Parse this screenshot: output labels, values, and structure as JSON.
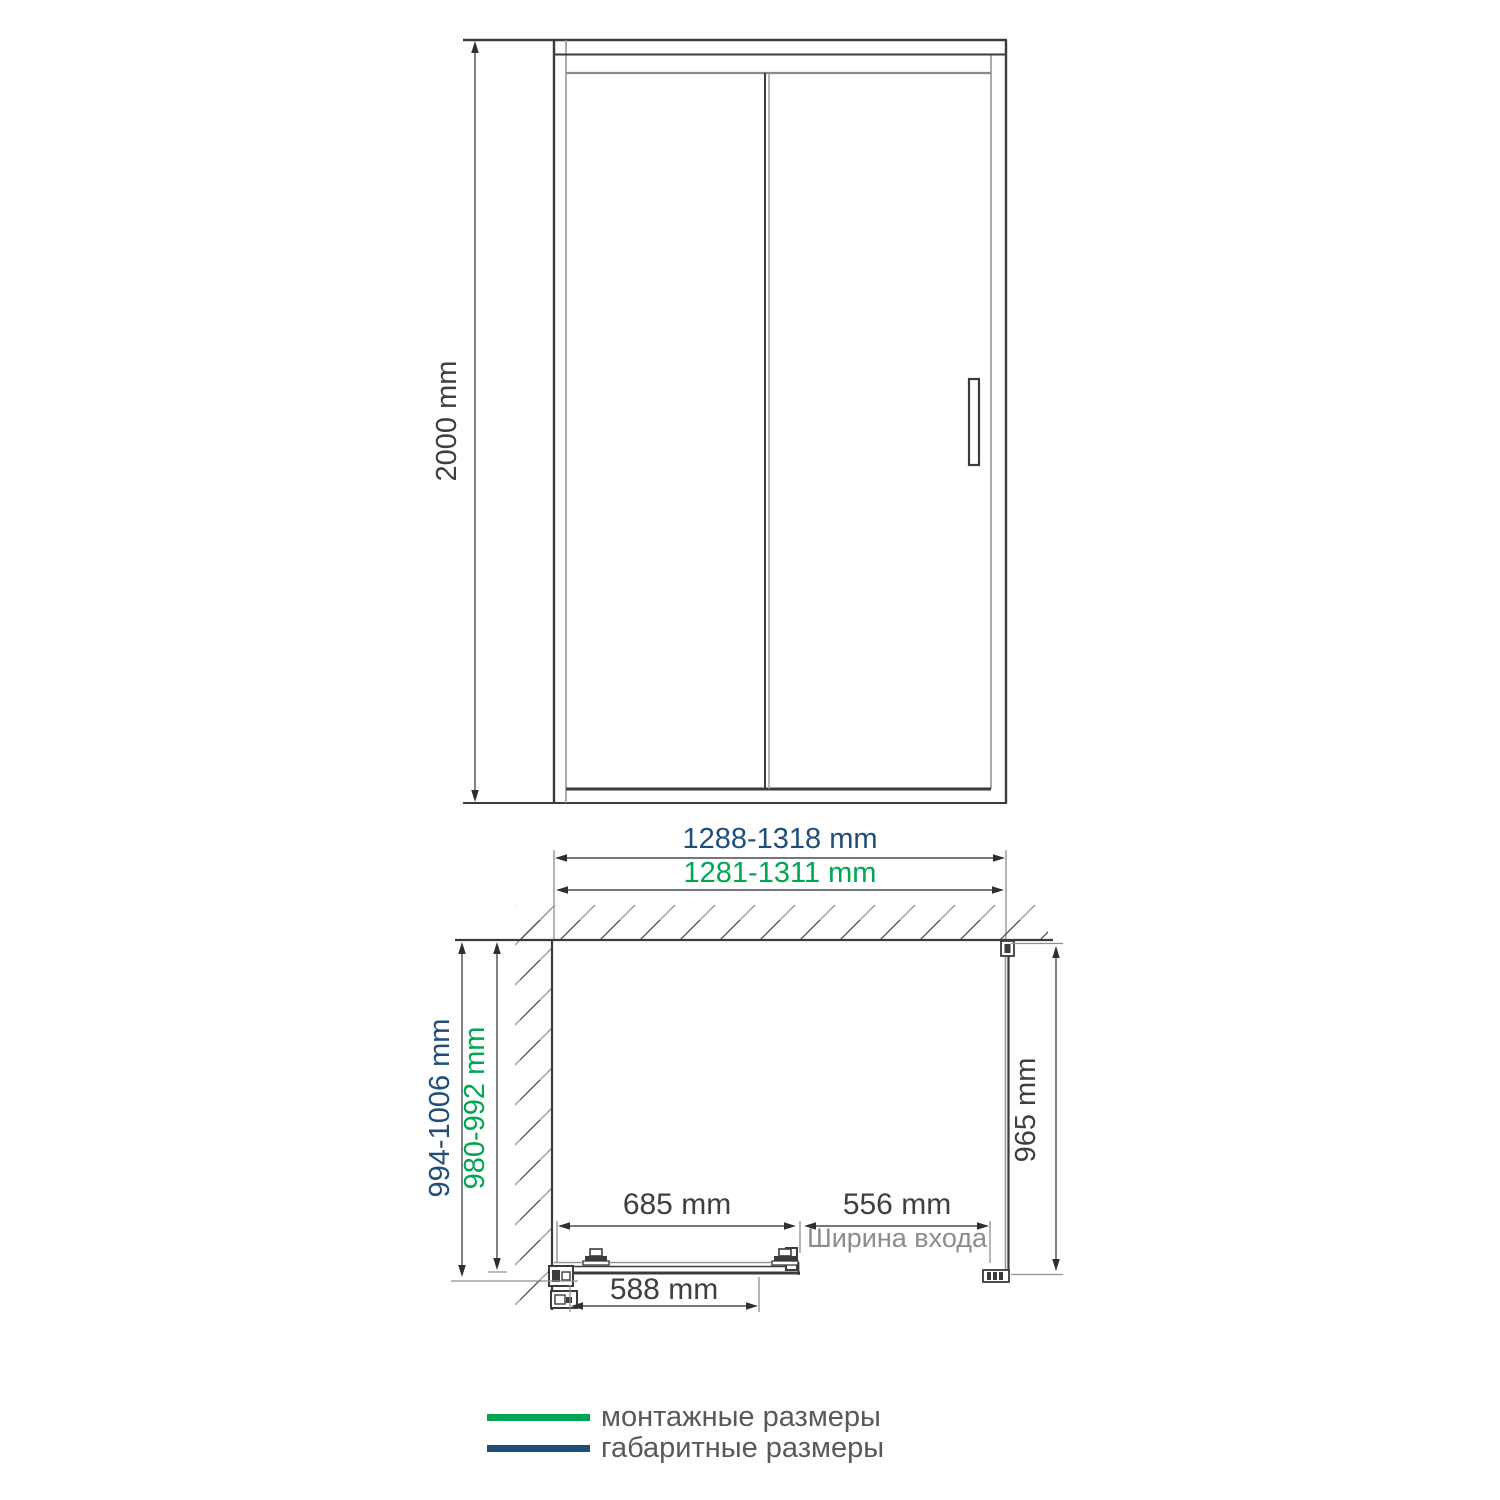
{
  "colors": {
    "mounting_green": "#00A651",
    "overall_navy": "#1F4E79",
    "ink_dark": "#3b3b3b",
    "ink_gray": "#979797",
    "caption_gray": "#8c8c8c",
    "legend_text_gray": "#595959"
  },
  "front_view": {
    "height_label": "2000 mm"
  },
  "plan_view": {
    "overall_width_label": "1288-1318 mm",
    "mounting_width_label": "1281-1311 mm",
    "overall_depth_label": "994-1006 mm",
    "mounting_depth_label": "980-992 mm",
    "side_panel_label": "965 mm",
    "fixed_segment_label": "685 mm",
    "entry_width_label": "556 mm",
    "entry_width_caption": "Ширина входа",
    "door_glass_label": "588 mm"
  },
  "legend": {
    "items": [
      {
        "label": "монтажные размеры",
        "color": "#00A651"
      },
      {
        "label": "габаритные размеры",
        "color": "#1F4E79"
      }
    ]
  }
}
